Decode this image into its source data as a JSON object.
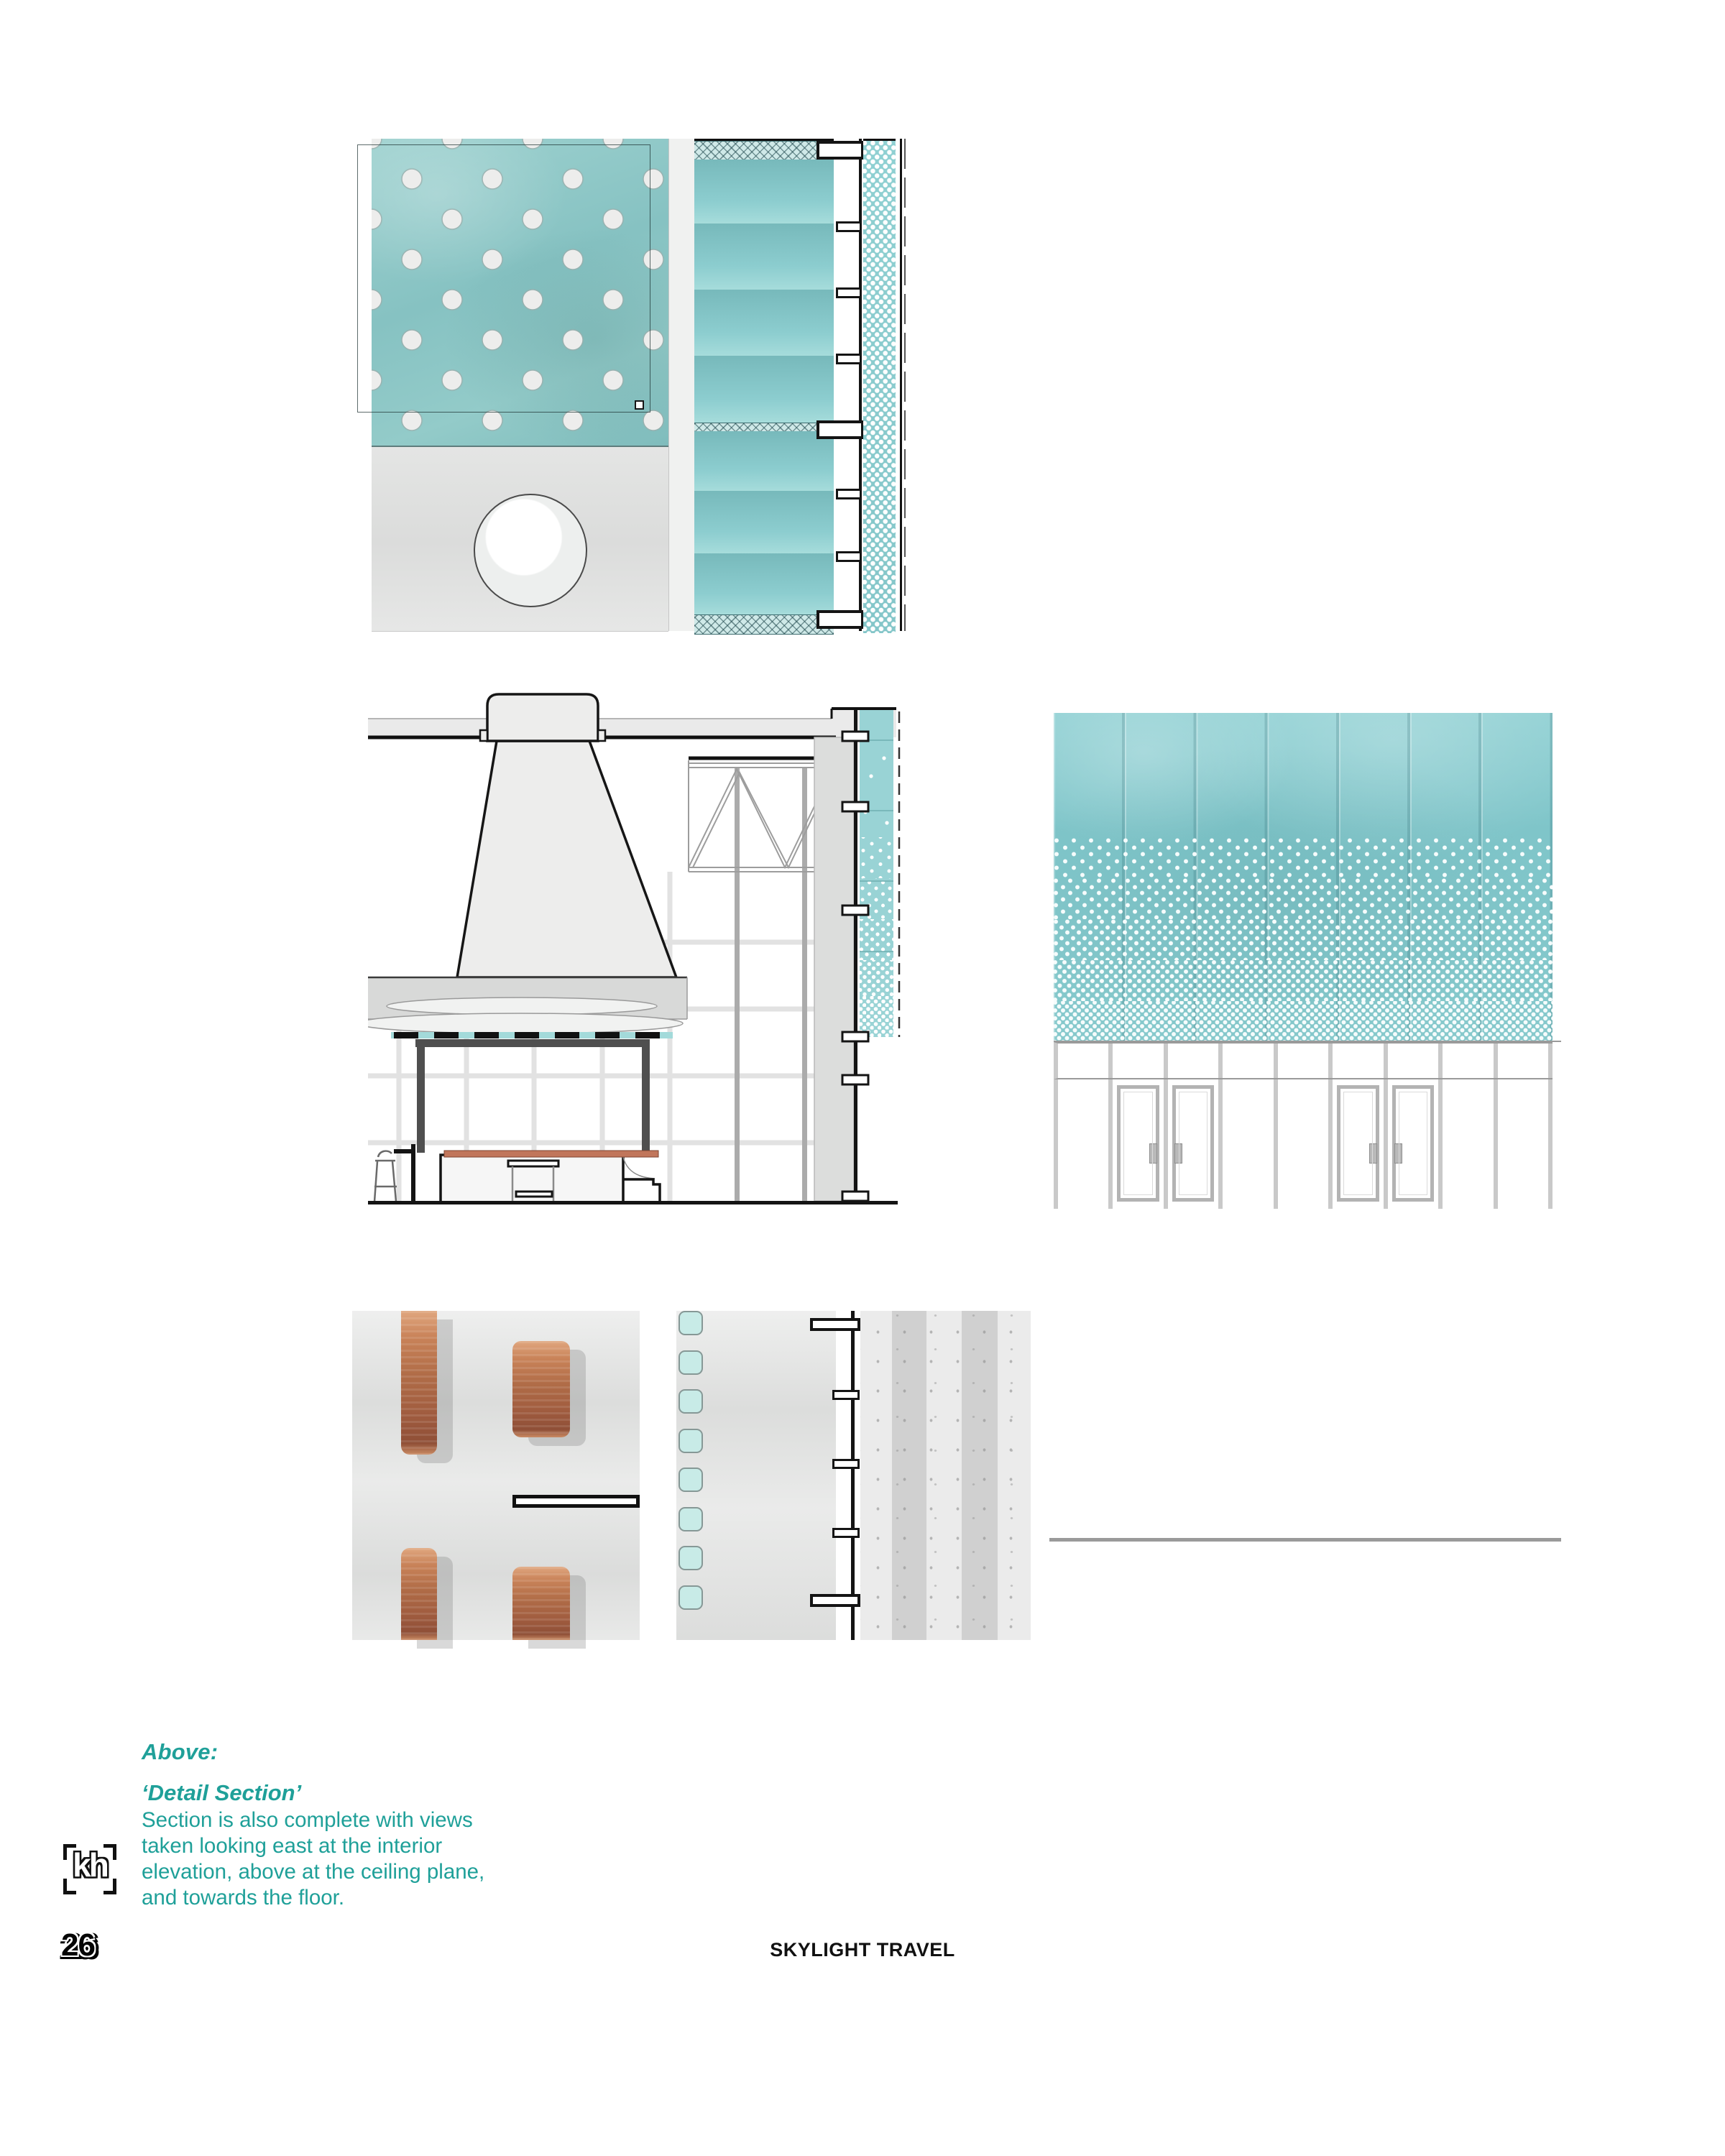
{
  "caption": {
    "heading": "Above:",
    "subheading": "‘Detail Section’",
    "body_lines": [
      "Section is also complete with views",
      "taken looking east at the interior",
      "elevation, above at the ceiling plane,",
      "and towards the floor."
    ]
  },
  "footer": {
    "title": "SKYLIGHT TRAVEL",
    "page_number": "26",
    "logo_text": "kh"
  },
  "colors": {
    "accent_teal": "#1FA099",
    "curtain_teal": "#86C9CC",
    "ceiling_panel_teal": "#8AC6C5",
    "dot_strip_teal": "#8FD0D2",
    "glass_square_teal": "#C8EBE7",
    "copper": "#B06C47",
    "counter_copper_line": "#C1765B",
    "line_black": "#141414",
    "frame_dark_gray": "#4F4F4F",
    "light_gray": "#E3E4E3",
    "terrazzo_gray": "#EBEBEB"
  },
  "drawings": {
    "ceiling_plan_detail": {
      "description": "reflected ceiling plan with perforated teal acoustic panel, skylight oculus, curtain track and perforated screen strip",
      "skylight_count": 1,
      "curtain_bays": 7,
      "track_clip_count": 8
    },
    "detail_section": {
      "description": "building section with plaster light-cone skylight, roof truss, curtain wall, reception desk with copper counter and stool",
      "stool_count": 1,
      "curtain_clip_count": 6
    },
    "interior_elevation": {
      "description": "interior elevation of gradient-perforated teal curtain above glazed storefront",
      "curtain_panel_count": 7,
      "glazing_bay_count": 9,
      "door_leaf_count": 4
    },
    "floor_plan_benches": {
      "description": "floor plan detail with copper benches on concrete floor",
      "copper_bench_count": 4
    },
    "floor_plan_wall_strip": {
      "description": "plan strip with glass blocks, wall line with clips and striped terrazzo sidewalk",
      "glass_square_count": 8,
      "wall_clip_count": 5
    }
  }
}
